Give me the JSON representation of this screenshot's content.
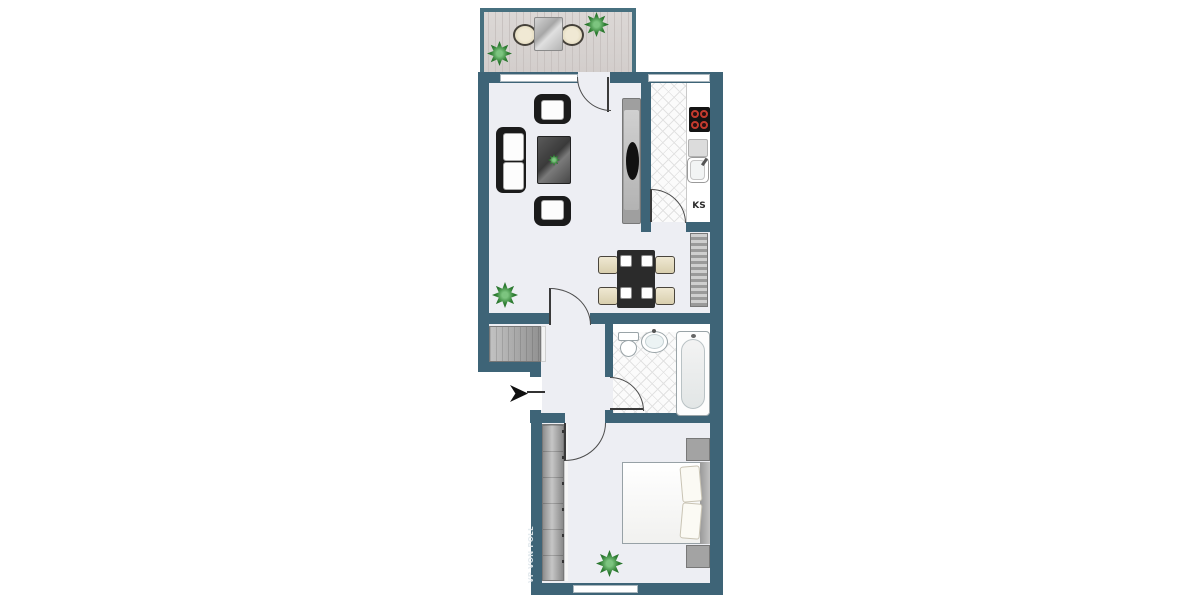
{
  "watermark": {
    "text": "VP VON POLL"
  },
  "kitchen": {
    "fridge_label": "KS"
  },
  "colors": {
    "wall": "#3e6477",
    "floor": "#edeef3",
    "deck": "#d8d4d2",
    "tile": "#fbfbfb",
    "furniture_dark": "#1d1d1d",
    "cabinet_gray": "#a0a0a0",
    "chair_beige": "#e8dfc5",
    "plant_green": "#2e7d32",
    "burner_red": "#c43b2e"
  },
  "rooms": [
    {
      "name": "balcony",
      "items": [
        "bistro-table",
        "chair",
        "chair",
        "plant",
        "plant"
      ]
    },
    {
      "name": "living-room",
      "items": [
        "sofa",
        "armchair",
        "armchair",
        "coffee-table",
        "tv-sideboard",
        "plant"
      ]
    },
    {
      "name": "kitchen",
      "items": [
        "hob",
        "sink",
        "counter",
        "fridge (KS)"
      ]
    },
    {
      "name": "dining-area",
      "items": [
        "dining-table",
        "4 chairs",
        "radiator"
      ]
    },
    {
      "name": "hallway",
      "items": [
        "built-in-closet",
        "entrance-arrow"
      ]
    },
    {
      "name": "bathroom",
      "items": [
        "toilet",
        "washbasin",
        "bathtub"
      ]
    },
    {
      "name": "bedroom",
      "items": [
        "wardrobe",
        "double-bed",
        "2 nightstands",
        "plant"
      ]
    }
  ]
}
